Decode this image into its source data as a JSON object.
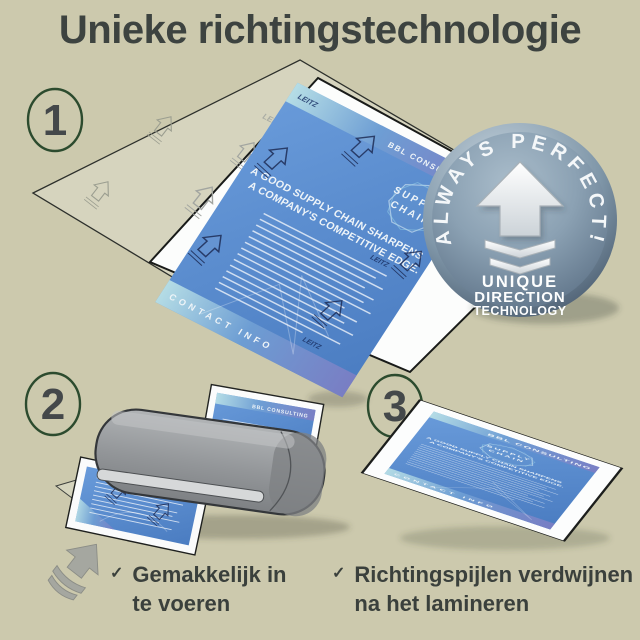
{
  "title": "Unieke richtingstechnologie",
  "steps": [
    {
      "number": "1"
    },
    {
      "number": "2"
    },
    {
      "number": "3"
    }
  ],
  "badge": {
    "arc_text": "ALWAYS PERFECT!",
    "line1": "UNIQUE",
    "line2": "DIRECTION",
    "line3": "TECHNOLOGY"
  },
  "sample_document": {
    "brand": "LEITZ",
    "header": "BBL CONSULTING",
    "emblem_word1": "SUPPLY",
    "emblem_word2": "CHAIN",
    "heading_line1": "A GOOD SUPPLY CHAIN SHARPENS",
    "heading_line2": "A COMPANY'S COMPETITIVE EDGE.",
    "footer": "CONTACT INFO"
  },
  "checklist": [
    {
      "check": "✓",
      "line1": "Gemakkelijk in",
      "line2": "te voeren"
    },
    {
      "check": "✓",
      "line1": "Richtingspijlen verdwijnen",
      "line2": "na het lamineren"
    }
  ],
  "colors": {
    "background": "#ccc9ad",
    "text": "#3d4340",
    "step_circle_green": "#2c4b2e",
    "step_number_gray": "#44484a",
    "document_blue": "#5b8ed2",
    "badge_face": "#8ba1b3",
    "badge_rim": "#48596c",
    "laminator_gray": "#939699",
    "gradient_teal": "#b9e2e6",
    "gradient_purple": "#7d7ec4"
  }
}
